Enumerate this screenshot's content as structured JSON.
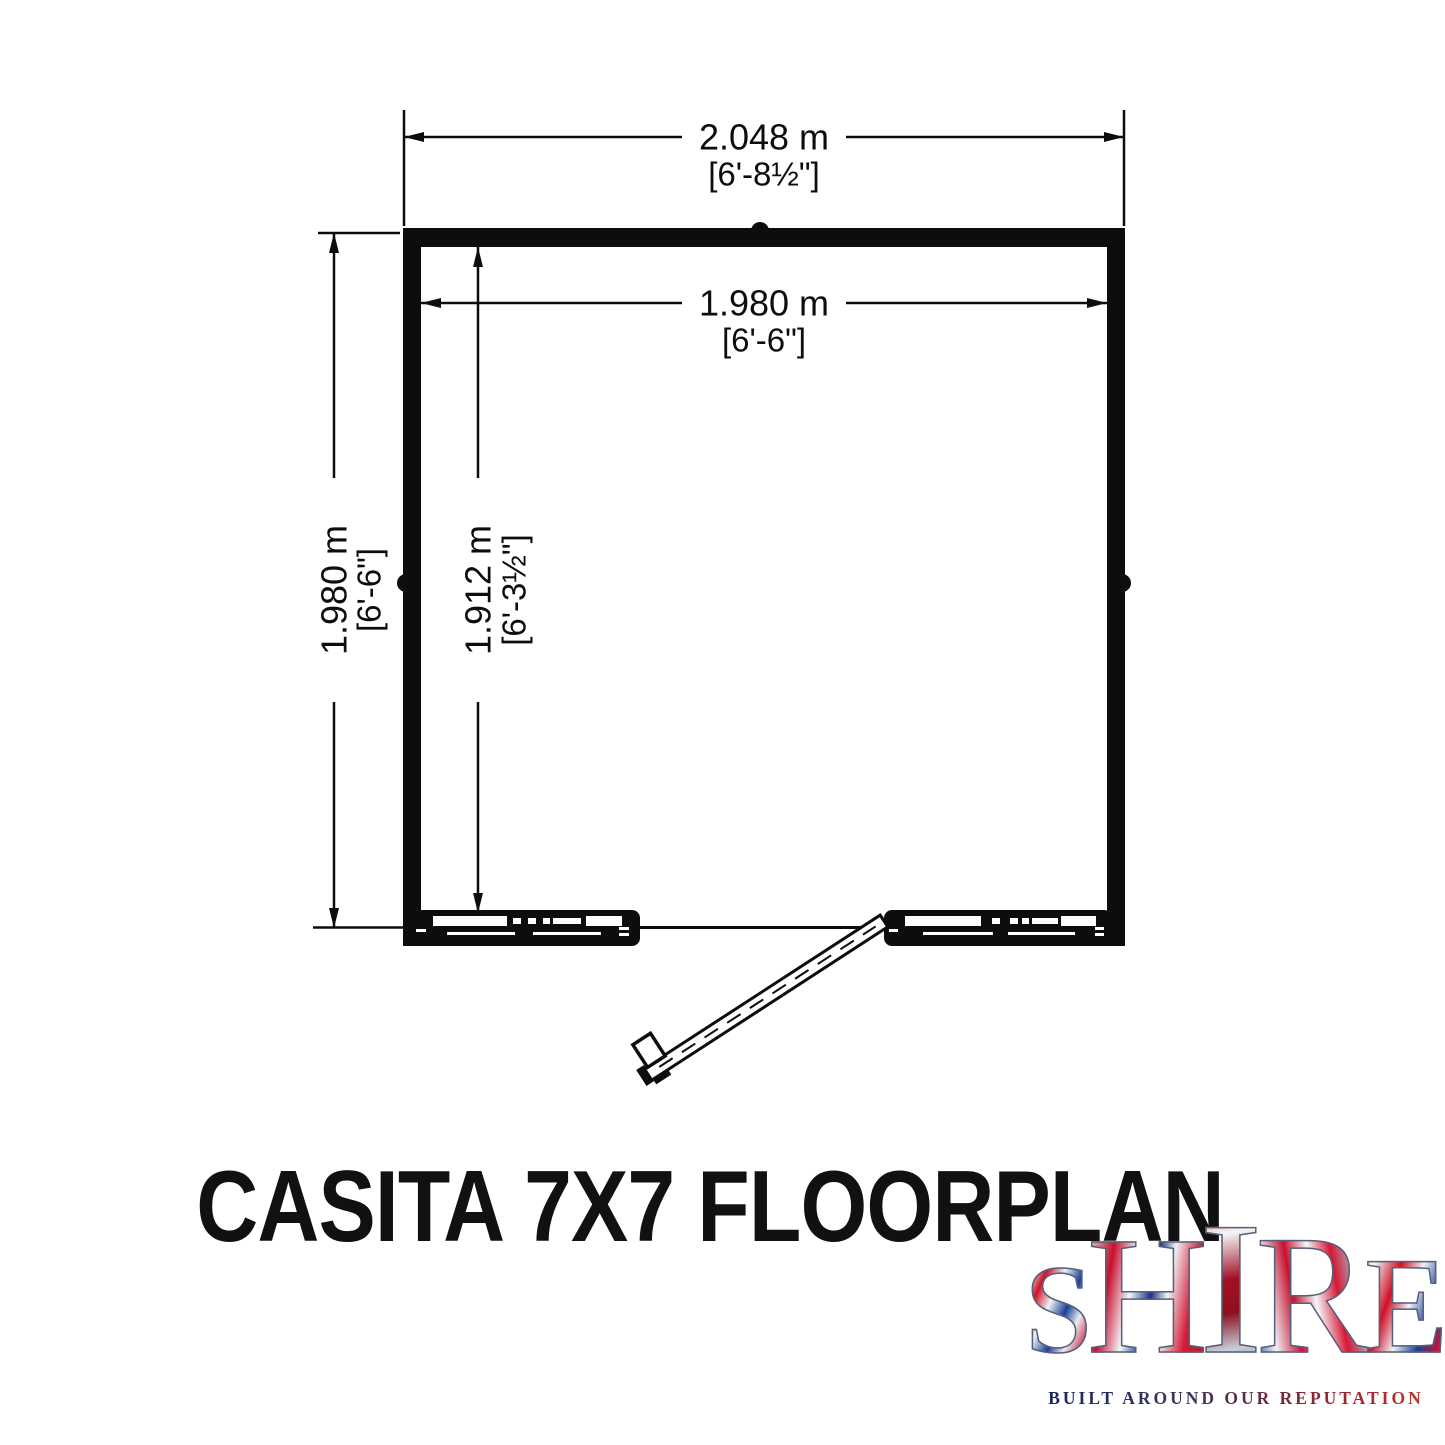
{
  "title": "CASITA 7X7 FLOORPLAN",
  "floorplan": {
    "dimensions": {
      "outer_width": {
        "metric": "2.048 m",
        "imperial": "[6'-8½\"]"
      },
      "inner_width": {
        "metric": "1.980 m",
        "imperial": "[6'-6\"]"
      },
      "outer_depth": {
        "metric": "1.980 m",
        "imperial": "[6'-6\"]"
      },
      "inner_depth": {
        "metric": "1.912 m",
        "imperial": "[6'-3½\"]"
      }
    }
  },
  "logo": {
    "brand": "SHIRE",
    "letters": [
      "S",
      "H",
      "I",
      "R",
      "E"
    ],
    "tagline": "BUILT AROUND OUR REPUTATION",
    "colors": {
      "red": "#c7102e",
      "blue": "#1b3f94",
      "white": "#f4f6f8"
    }
  },
  "colors": {
    "line": "#0d0d0d",
    "background": "#ffffff"
  }
}
